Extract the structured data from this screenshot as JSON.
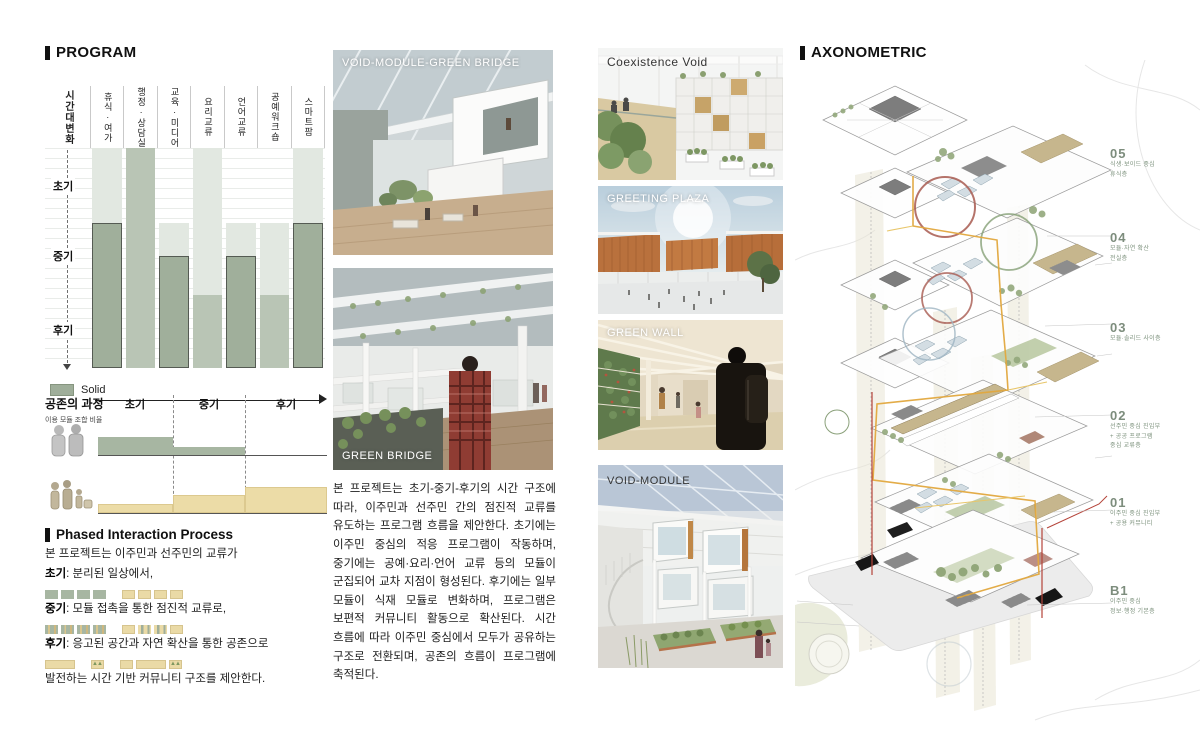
{
  "program": {
    "title": "PROGRAM",
    "time_axis_label": "시간대변화",
    "phase_labels": [
      "초기",
      "중기",
      "후기"
    ],
    "legend_solid": "Solid",
    "chart_data": {
      "type": "bar",
      "orientation": "vertical-time-bands",
      "y_axis": "시간대변화 (초기 → 후기)",
      "categories": [
        "휴식·여가",
        "행정·상담실",
        "교육·미디어",
        "요리교류",
        "언어교류",
        "공예워크숍",
        "스마트팜"
      ],
      "tones": {
        "light": "#e2e8e1",
        "medium": "#b9c5b5",
        "dark": "#a0af9b"
      },
      "series": [
        {
          "name": "휴식·여가",
          "segments": [
            {
              "tone": "light",
              "from": 0,
              "to": 0.34
            },
            {
              "tone": "dark",
              "from": 0.34,
              "to": 1
            }
          ]
        },
        {
          "name": "행정·상담실",
          "segments": [
            {
              "tone": "medium",
              "from": 0,
              "to": 1
            }
          ]
        },
        {
          "name": "교육·미디어",
          "segments": [
            {
              "tone": "light",
              "from": 0.34,
              "to": 0.49
            },
            {
              "tone": "dark",
              "from": 0.49,
              "to": 1
            }
          ]
        },
        {
          "name": "요리교류",
          "segments": [
            {
              "tone": "light",
              "from": 0,
              "to": 0.67
            },
            {
              "tone": "medium",
              "from": 0.67,
              "to": 1
            }
          ]
        },
        {
          "name": "언어교류",
          "segments": [
            {
              "tone": "light",
              "from": 0.34,
              "to": 0.49
            },
            {
              "tone": "dark",
              "from": 0.49,
              "to": 1
            }
          ]
        },
        {
          "name": "공예워크숍",
          "segments": [
            {
              "tone": "light",
              "from": 0.34,
              "to": 0.67
            },
            {
              "tone": "medium",
              "from": 0.67,
              "to": 1
            }
          ]
        },
        {
          "name": "스마트팜",
          "segments": [
            {
              "tone": "light",
              "from": 0,
              "to": 0.34
            },
            {
              "tone": "dark",
              "from": 0.34,
              "to": 1
            }
          ]
        }
      ]
    }
  },
  "process": {
    "title": "공존의 과정",
    "subtitle": "이용 모듈 조합 비율",
    "phase_labels": [
      "초기",
      "중기",
      "후기"
    ],
    "chart_data": {
      "type": "area",
      "x": [
        "초기",
        "중기",
        "후기"
      ],
      "series": [
        {
          "name": "green-modules",
          "color": "#a7b6a2",
          "values": [
            1.0,
            0.45,
            0.0
          ]
        },
        {
          "name": "tan-modules",
          "color": "#ecdca7",
          "values": [
            0.35,
            0.7,
            1.0
          ]
        }
      ]
    }
  },
  "phased": {
    "title": "Phased Interaction Process",
    "intro": "본 프로젝트는 이주민과 선주민의 교류가",
    "items": [
      {
        "label": "초기",
        "text": ": 분리된 일상에서,",
        "swatches": [
          "g",
          "g",
          "g",
          "g",
          "gap",
          "t",
          "t",
          "t",
          "t"
        ]
      },
      {
        "label": "중기",
        "text": ": 모듈 접촉을 통한 점진적 교류로,",
        "swatches": [
          "gt",
          "gt",
          "gt",
          "gt",
          "gap",
          "t",
          "tg",
          "tg",
          "t"
        ]
      },
      {
        "label": "후기",
        "text": ": 응고된 공간과 자연 확산을 통한 공존으로",
        "swatches": [
          "tw",
          "gap",
          "tt",
          "gap",
          "t",
          "tw",
          "tt"
        ]
      }
    ],
    "outro": "발전하는 시간 기반 커뮤니티 구조를 제안한다."
  },
  "middle_images": [
    {
      "label": "VOID-MODULE-GREEN BRIDGE"
    },
    {
      "label": "GREEN BRIDGE"
    }
  ],
  "description_paragraph": "본 프로젝트는 초기-중기-후기의 시간 구조에 따라, 이주민과 선주민 간의 점진적 교류를 유도하는 프로그램 흐름을 제안한다. 초기에는 이주민 중심의 적응 프로그램이 작동하며, 중기에는 공예·요리·언어 교류 등의 모듈이 군집되어 교차 지점이 형성된다. 후기에는 일부 모듈이 식재 모듈로 변화하며, 프로그램은 보편적 커뮤니티 활동으로 확산된다. 시간 흐름에 따라 이주민 중심에서 모두가 공유하는 구조로 전환되며, 공존의 흐름이 프로그램에 축적된다.",
  "gallery_images": [
    {
      "label": "Coexistence Void"
    },
    {
      "label": "GREETING PLAZA"
    },
    {
      "label": "GREEN WALL"
    },
    {
      "label": "VOID-MODULE"
    }
  ],
  "axonometric": {
    "title": "AXONOMETRIC",
    "floors": [
      {
        "num": "05",
        "lines": [
          "식생·보이드 중심",
          "휴식층"
        ]
      },
      {
        "num": "04",
        "lines": [
          "모듈·자연 확산",
          "전실층"
        ]
      },
      {
        "num": "03",
        "lines": [
          "모듈·솔리드 사이층"
        ]
      },
      {
        "num": "02",
        "lines": [
          "선주민 중심 진입부",
          "+ 공공 프로그램",
          "중심 교류층"
        ]
      },
      {
        "num": "01",
        "lines": [
          "이주민 중심 진입부",
          "+ 공용 커뮤니티"
        ]
      },
      {
        "num": "B1",
        "lines": [
          "이주민 중심",
          "정보·행정 기본층"
        ]
      }
    ]
  },
  "colors": {
    "bar_light": "#e2e8e1",
    "bar_medium": "#b9c5b5",
    "bar_dark": "#a0af9b",
    "tan": "#ecdca7",
    "accent_red": "#a85a50",
    "accent_yellow": "#e2a83e",
    "floor_label_green": "#7c917c"
  }
}
